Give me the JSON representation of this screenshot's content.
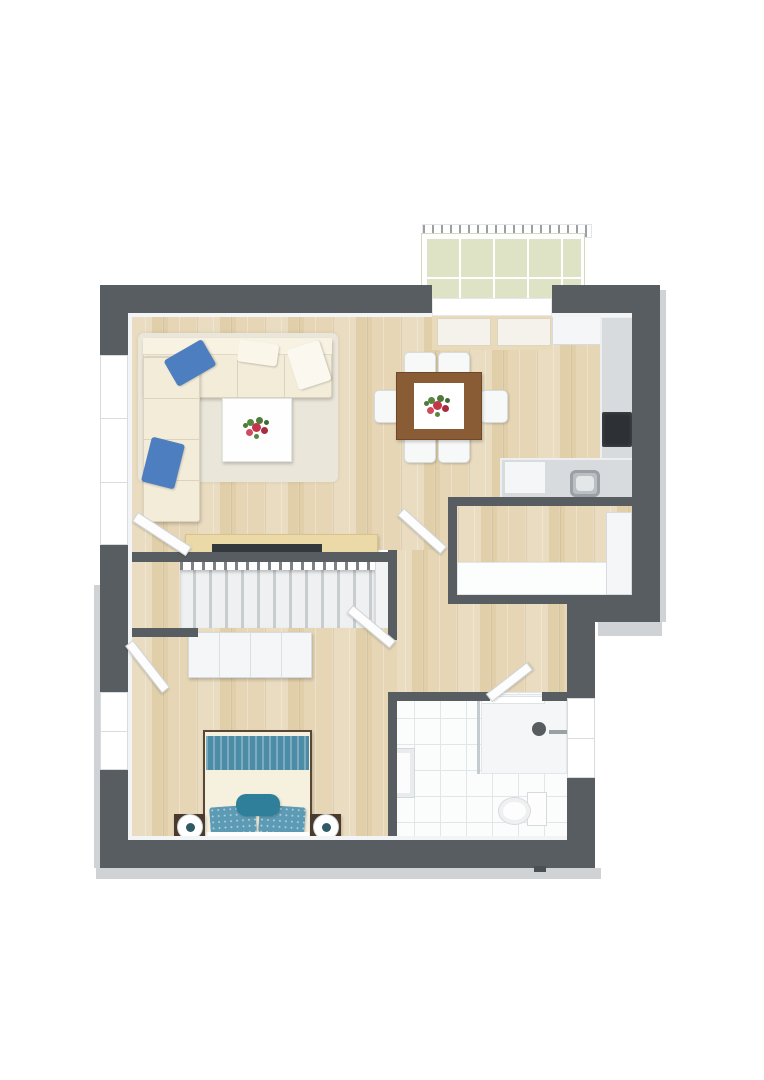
{
  "image_kind": "3d-floor-plan-render",
  "palette": {
    "background": "#ffffff",
    "wall": "#585d62",
    "wall_outer_edge": "#cfd3d5",
    "wood_floor": "#e6d6b6",
    "wood_streak": "#e0cfa9",
    "balcony_tile": "#dfe3c6",
    "bath_tile": "#fbfcfc",
    "bath_grout": "#e3e6e8",
    "kitchen_counter": "#d7dbdd",
    "cooktop": "#2d3135",
    "white_cabinet": "#f5f6f7",
    "sofa_cream": "#f3ecd9",
    "pillow_blue": "#4c7ec0",
    "rug": "#eae6da",
    "dining_table_wood": "#8a5c36",
    "table_runner": "#ffffff",
    "flower_red": "#c2354b",
    "flower_green": "#4e7a3a",
    "bed_duvet": "#f6f0df",
    "bed_foot_teal": "#4d8ca6",
    "bed_pillow_teal": "#5d9bb5",
    "bed_cushion_teal": "#2f7f9b",
    "nightstand_wood": "#4a3a2e",
    "sideboard_wood": "#ecd9a8",
    "tv_dark": "#33383c",
    "stair_tread": "#eef0f1",
    "door_leaf": "#fdfdfd"
  },
  "rooms": {
    "balcony": {
      "name": "balcony",
      "tile_cols": 5,
      "tile_rows": 2
    },
    "living_dining": {
      "name": "living-dining-room"
    },
    "kitchen": {
      "name": "kitchen"
    },
    "pantry": {
      "name": "storage-room"
    },
    "hall": {
      "name": "hallway"
    },
    "stairs": {
      "name": "staircase",
      "tread_count": 13
    },
    "bedroom": {
      "name": "bedroom"
    },
    "bathroom": {
      "name": "bathroom"
    }
  },
  "furniture": {
    "living": [
      "corner-sofa",
      "blue-pillows",
      "coffee-table",
      "flower-centerpiece",
      "rug",
      "tv-sideboard"
    ],
    "dining": [
      "dining-table",
      "six-chairs",
      "flower-centerpiece"
    ],
    "kitchen": [
      "counter-run",
      "cooktop",
      "sink",
      "appliance",
      "upper-cabinets"
    ],
    "pantry": [
      "worktop",
      "tall-cabinet"
    ],
    "bedroom": [
      "double-bed",
      "teal-pillows",
      "two-nightstands",
      "two-lamps",
      "wardrobe"
    ],
    "bathroom": [
      "shower",
      "glass-screen",
      "toilet",
      "cabinet"
    ]
  },
  "counts": {
    "dining_chairs": 6,
    "stair_treads": 13,
    "windows": 3,
    "door_leaves": 5
  }
}
